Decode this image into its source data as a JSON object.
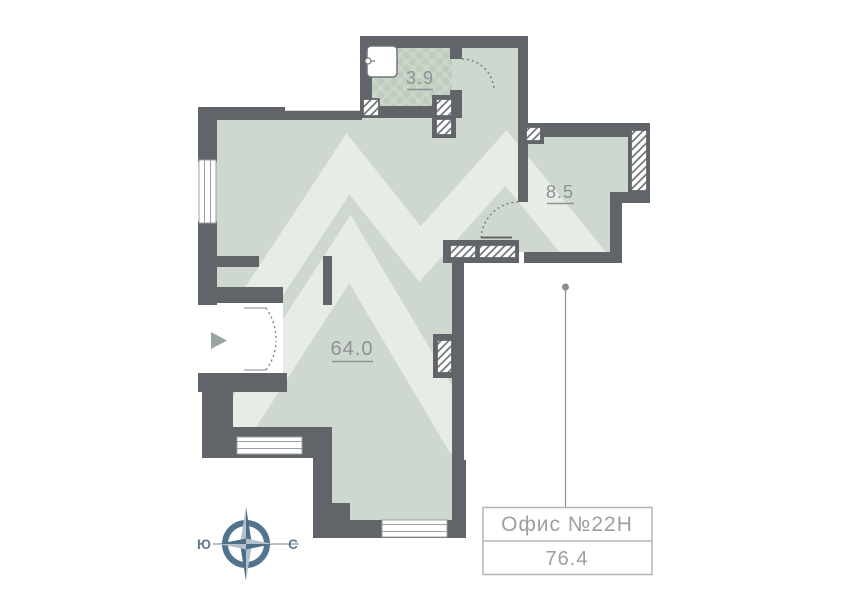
{
  "plan": {
    "rooms": [
      {
        "id": "bathroom",
        "area_label": "3.9"
      },
      {
        "id": "room-85",
        "area_label": "8.5"
      },
      {
        "id": "main-room",
        "area_label": "64.0"
      }
    ],
    "info_box": {
      "title": "Офис №22Н",
      "area_value": "76.4"
    },
    "compass": {
      "west_label": "Ю",
      "east_label": "С"
    },
    "colors": {
      "wall": "#616569",
      "floor": "#cfd8ce",
      "tile_base": "#cbd5ca",
      "tile_dot": "#bfcdbe",
      "watermark": "rgba(255,255,255,0.5)",
      "room_label_text": "#8d9295",
      "info_box_border": "#b3b7ba",
      "info_box_text": "#9ba0a3",
      "compass_dark": "#4d6e87",
      "compass_light": "#b3c1cb",
      "hatch_line": "#6e7275",
      "window_frame": "#9aa0a4",
      "leader_line": "#8b8f92"
    }
  }
}
